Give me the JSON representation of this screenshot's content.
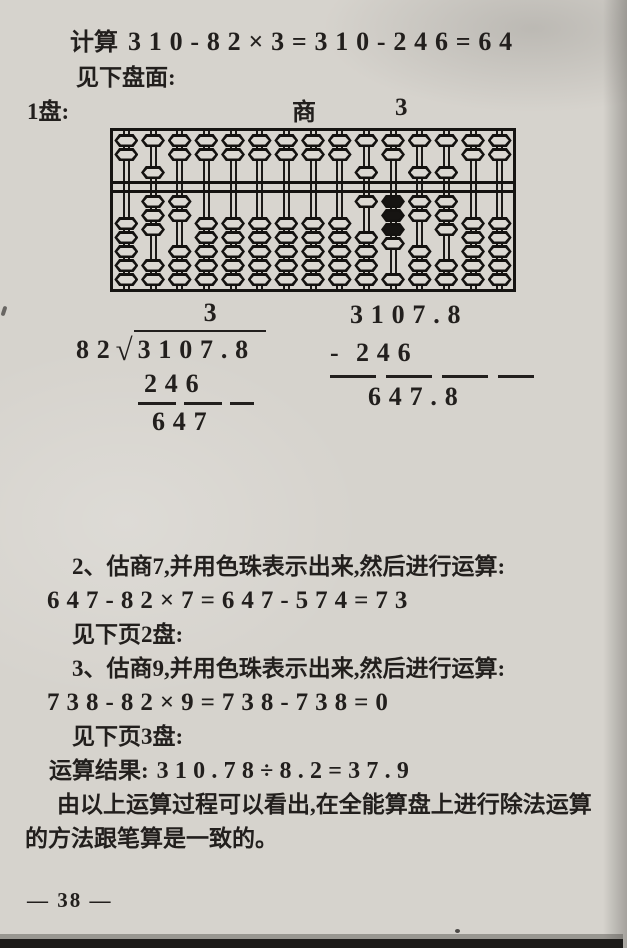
{
  "page": {
    "footer": "— 38 —"
  },
  "top": {
    "calc_label": "计算",
    "calc_eq": "310-82×3=310-246=64",
    "see_board": "见下盘面:",
    "board_label": "1盘:",
    "quotient_label": "商",
    "quotient_digit": "3"
  },
  "abacus": {
    "rod_count": 15,
    "upper_beads_per_rod": 2,
    "lower_beads_per_rod": 5,
    "rod_states": [
      {
        "upper": 0,
        "lower": 0,
        "black": 0
      },
      {
        "upper": 1,
        "lower": 3,
        "black": 0
      },
      {
        "upper": 0,
        "lower": 2,
        "black": 0
      },
      {
        "upper": 0,
        "lower": 0,
        "black": 0
      },
      {
        "upper": 0,
        "lower": 0,
        "black": 0
      },
      {
        "upper": 0,
        "lower": 0,
        "black": 0
      },
      {
        "upper": 0,
        "lower": 0,
        "black": 0
      },
      {
        "upper": 0,
        "lower": 0,
        "black": 0
      },
      {
        "upper": 0,
        "lower": 0,
        "black": 0
      },
      {
        "upper": 1,
        "lower": 1,
        "black": 0
      },
      {
        "upper": 0,
        "lower": 4,
        "black": 3
      },
      {
        "upper": 1,
        "lower": 2,
        "black": 0
      },
      {
        "upper": 1,
        "lower": 3,
        "black": 0
      },
      {
        "upper": 0,
        "lower": 0,
        "black": 0
      },
      {
        "upper": 0,
        "lower": 0,
        "black": 0
      }
    ]
  },
  "division": {
    "quotient": "3",
    "divisor": "82",
    "radical_sign": "√",
    "dividend": "3107.8",
    "product": "246",
    "remainder": "647"
  },
  "subtraction": {
    "minuend": "3107.8",
    "minus_sign": "-",
    "subtrahend": "246",
    "result": "647.8"
  },
  "body": {
    "lines": [
      "2、估商7,并用色珠表示出来,然后进行运算:",
      "647-82×7=647-574=73",
      "见下页2盘:",
      "3、估商9,并用色珠表示出来,然后进行运算:",
      "738-82×9=738-738=0",
      "见下页3盘:",
      "由以上运算过程可以看出,在全能算盘上进行除法运算",
      "的方法跟笔算是一致的。"
    ],
    "result_label": "运算结果:",
    "result_eq": "310.78÷8.2=37.9"
  }
}
